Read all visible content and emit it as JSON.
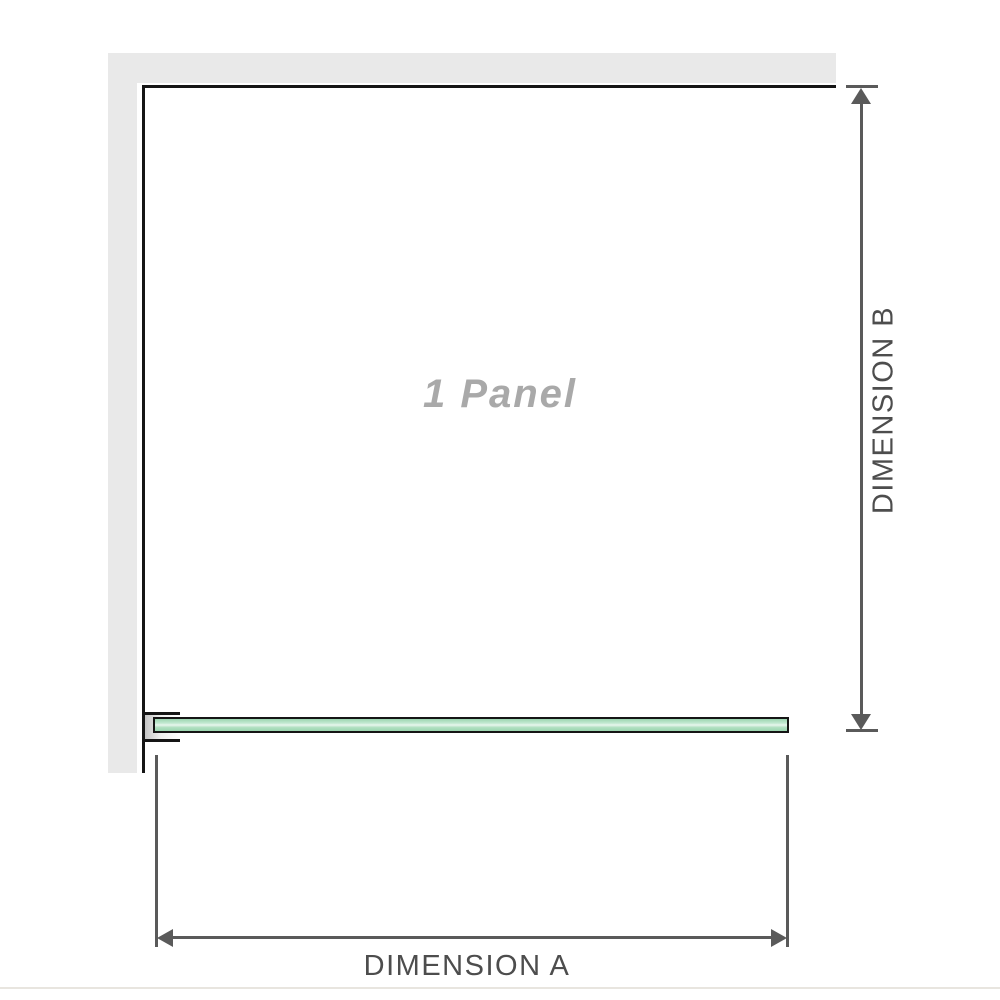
{
  "diagram": {
    "panel_label": "1 Panel",
    "dimension_a_label": "DIMENSION A",
    "dimension_b_label": "DIMENSION B",
    "colors": {
      "wall": "#e9e9e9",
      "panel_border": "#151515",
      "glass_border": "#151515",
      "glass_fill": "#b1e0c2",
      "glass_highlight": "#e8f7ee",
      "dimension_line": "#5a5a5a",
      "label_text": "#4d4d4d",
      "panel_label_text": "#a9a9a9",
      "baseline_rule": "#e8e5df"
    }
  }
}
